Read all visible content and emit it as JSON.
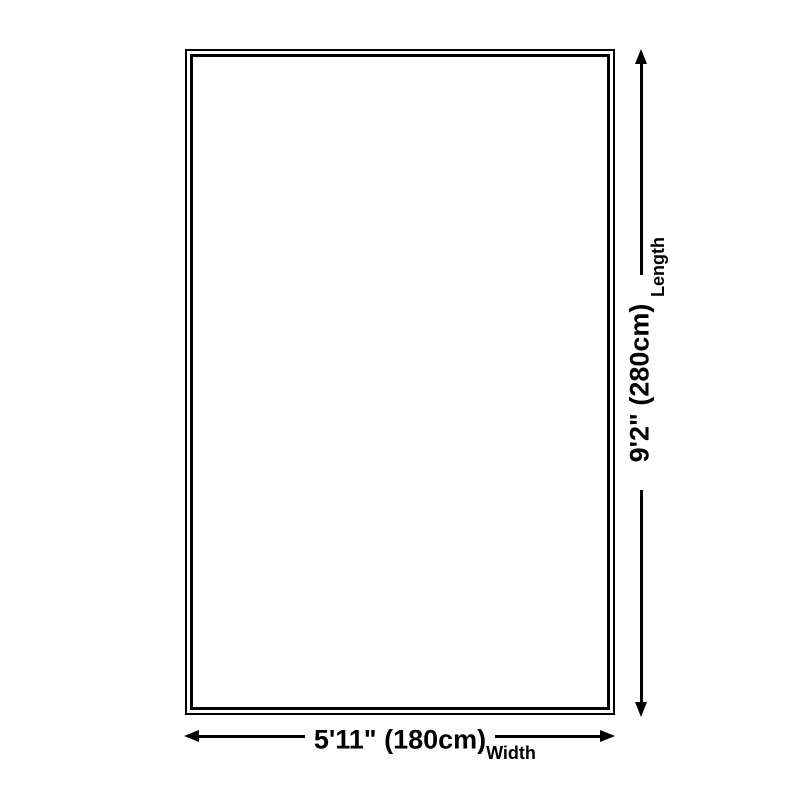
{
  "diagram": {
    "background_color": "#ffffff",
    "line_color": "#000000",
    "length_dimension": {
      "value": "9'2\" (280cm)",
      "label": "Length"
    },
    "width_dimension": {
      "value": "5'11\" (180cm)",
      "label": "Width"
    }
  }
}
